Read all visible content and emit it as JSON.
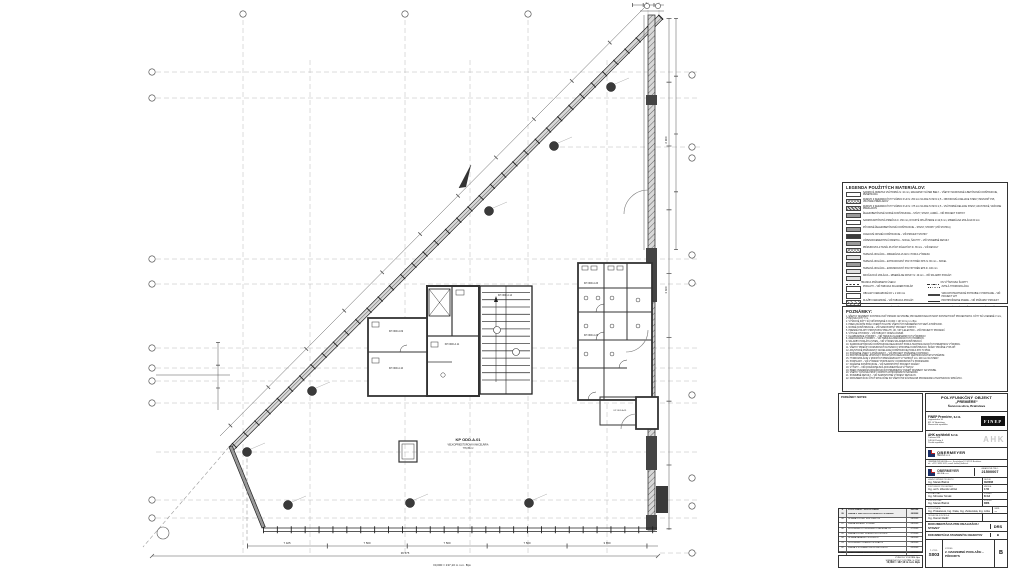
{
  "plan": {
    "labels": {
      "open_space_code": "KP ODD.A.01",
      "open_space_name": "VEĽKOPRIESTOROVÁ KANCELÁRIA",
      "open_space_area": "779,35 m²",
      "core_room": "KP ODD.A.11",
      "stair_room": "KP ODD.A.14",
      "room_w1": "KP ODD.A.09",
      "room_w2": "KP ODD.A.10",
      "wc_room_1": "KP ODD.A.26",
      "wc_room_2": "KP ODD.A.28",
      "corner_room": "KP ODD.A.31"
    },
    "dims": {
      "bottom": [
        "7 425",
        "7 500",
        "7 500",
        "7 500",
        "3 650"
      ],
      "bottom_total": "36 575",
      "right_upper": "6 900",
      "right_lower": "3 600",
      "datum_note": "±0,000 = 137,10 m n.m. Bpv"
    }
  },
  "legend": {
    "title": "LEGENDA POUŽITÝCH MATERIÁLOV:",
    "rows": [
      {
        "cls": "plain",
        "t": "SADROVÁ OMIETKA VNÚTORNÁ hr. 10 mm, MALIARSKY NÁTER BIELY – VŠETKY MUROVANÉ A BETÓNOVÉ KONŠTRUKCIE, PENETRÁCIA"
      },
      {
        "cls": "cross",
        "t": "MURIVO Z KERAMICKÝCH TVÁRNIC P+D hr. 250 mm NA MALTU MVC 2,5 – OBVODOVÉ A DELIACE STENY, PEVNOSŤ P15, VRÁTANE PREKLADOV"
      },
      {
        "cls": "hatchdark",
        "t": "MURIVO Z KERAMICKÝCH TVÁRNIC P+D hr. 175 mm NA MALTU MVC 2,5 – VNÚTORNÉ DELIACE STENY, AKUSTICKÉ, VRÁTANE PREKLADOV"
      },
      {
        "cls": "gray",
        "t": "ŽELEZOBETÓNOVÉ NOSNÉ KONŠTRUKCIE – STĹPY, STENY, JADRÁ – VIĎ PROJEKT STATIKY"
      },
      {
        "cls": "plain",
        "t": "SADROKARTÓNOVÁ PRIEČKA hr. 150 mm, DVOJITÉ OPLÁŠTENIE 2×12,5 mm, MINERÁLNA IZOLÁCIA 60 mm"
      },
      {
        "cls": "gray",
        "t": "PÔVODNÉ ŽELEZOBETÓNOVÉ KONŠTRUKCIE – STENY, STROPY (VIĎ STATIKA)"
      },
      {
        "cls": "dark",
        "t": "OCEĽOVÉ NOSNÉ KONŠTRUKCIE – VIĎ PROJEKT STATIKY"
      },
      {
        "cls": "gray",
        "t": "VÁPENNOCEMENTOVÁ OMIETKA – SOKLE, ŠACHTY – VIĎ STAVEBNÉ DETAILY"
      },
      {
        "cls": "cross",
        "t": "PRÍMUROVKA Z TEHÁL PLNÝCH PÁLENÝCH hr. 65 mm – VIĎ DETAILY"
      },
      {
        "cls": "light",
        "t": "TEPELNÁ IZOLÁCIA – MINERÁLNA VLNA hr. PODĽA VÝKRESU"
      },
      {
        "cls": "gray",
        "t": "TEPELNÁ IZOLÁCIA – EXTRUDOVANÝ POLYSTYRÉN XPS hr. 80 mm – SOKEL"
      },
      {
        "cls": "light",
        "t": "TEPELNÁ IZOLÁCIA – EXPANDOVANÝ POLYSTYRÉN EPS hr. 100 mm"
      },
      {
        "cls": "light",
        "t": "KROČAJOVÁ IZOLÁCIA – MINERÁLNE DOSKY hr. 40 mm – VIĎ SKLADBY PODLÁH"
      },
      {
        "cls": "dashline",
        "t": "HRANICA POŽIARNEHO ÚSEKU",
        "r": "OS VÝŤAHOVEJ ŠACHTY",
        "rcls": "dashdot"
      },
      {
        "cls": "plain",
        "t": "PODLAHY – VIĎ TABUĽKA SKLADIEB PODLÁH",
        "r": "ZVISLÁ HYDROIZOLÁCIA",
        "rcls": "dotted"
      },
      {
        "cls": "plain",
        "t": "OBKLADY KERAMICKÉ DO v. 2 100 mm",
        "r": "VZDUCHOTECHNICKÉ POTRUBIE V PODHĽADE – VIĎ PROJEKT VZT",
        "rcls": "thick"
      },
      {
        "cls": "hatch",
        "t": "DLAŽBY KERAMICKÉ – VIĎ TABUĽKA PODLÁH",
        "r": "PROTIPOŽIARNE DVERE – VIĎ POŽIARNY PROJEKT",
        "rcls": "thin"
      },
      {
        "cls": "plain",
        "t": "PODHĽADY SADROKARTÓNOVÉ",
        "r": "ZASKLENÁ FASÁDA (VIĎ PROJEKT FASÁDY + TČ)",
        "rcls": "thick"
      }
    ]
  },
  "notes": {
    "title": "POZNÁMKY:",
    "lines": [
      "1.  VŠETKY ROZMERY KONTROLOVAŤ PRIAMO NA STAVBE; PRI NEZROVNALOSTIACH KONTAKTOVAŤ PROJEKTANTA. KÓTY SÚ UVEDENÉ V mm, VÝŠKOVÉ KÓTY V m.",
      "2.  VÝŠKOVÉ KÓTY SÚ VZŤAHOVANÉ K ±0,000 = 137,10 m n.m. Bpv.",
      "3.  PRED ZAČATÍM PRÁC OVERIŤ POLOHU VŠETKÝCH INŽINIERSKYCH SIETÍ A PRÍPOJOK.",
      "4.  NOSNÉ KONŠTRUKCIE – VIĎ SAMOSTATNÝ PROJEKT STATIKY.",
      "5.  PRESNÉ POLOHY PROSTUPOV PRE ZTI, ÚK, VZT A ELEKTRO – VIĎ PROJEKTY PROFESIÍ.",
      "6.  VÝPLNE OTVOROV – VIĎ TABUĽKY OKIEN A DVERÍ.",
      "7.  KLAMPIARSKE VÝROBKY – VIĎ TABUĽKA KLAMPIARSKYCH VÝROBKOV.",
      "8.  ZÁMOČNÍCKE VÝROBKY – VIĎ TABUĽKA ZÁMOČNÍCKYCH VÝROBKOV.",
      "9.  SKLADBY PODLÁH A STIEN – VIĎ VÝKRES SKLADIEB KONŠTRUKCIÍ.",
      "10. SADROKARTÓNOVÉ KONŠTRUKCIE REALIZOVAŤ PODĽA TECHNOLOGICKÝCH PREDPISOV VÝROBCU.",
      "11. VŠETKY PRIEČKY DOMUROVAŤ NA TESNO K STROPNEJ KONŠTRUKCII, ŠKÁRY PRUŽNE VYPLNIŤ.",
      "12. AKUSTICKÉ POŽIADAVKY NA DELIACE KONŠTRUKCIE PODĽA STN 73 0532.",
      "13. POŽIARNE ÚSEKY A POŽIADAVKY – VIĎ PROJEKT POŽIARNEJ OCHRANY.",
      "14. PROTIPOŽIARNE UPCHÁVKY PROSTUPOV REALIZOVAŤ CERTIFIKOVANÝM SYSTÉMOM.",
      "15. HYDROIZOLÁCIE V MOKRÝCH PREVÁDZKACH VYTIAHNUŤ min. 200 mm NA STENY.",
      "16. PODHĽADY – VIĎ VÝKRESY PODHĽADOV; KOORDINOVAŤ S PROFESIAMI.",
      "17. FASÁDNE KONŠTRUKCIE – VIĎ SAMOSTATNÝ PROJEKT FASÁDY.",
      "18. VÝŤAHY – VIĎ DODÁVATEĽSKÁ DOKUMENTÁCIA VÝŤAHOV.",
      "19. PRED OSADENÍM ZARIAĎOVACÍCH PREDMETOV OVERIŤ ROZMERY NA STAVBE.",
      "20. VŠETKY KOVOVÉ PRVKY OPATRIŤ ANTIKORÓZNYM NÁTEROM.",
      "21. STAVEBNÉ DETAILY – VIĎ SAMOSTATNÉ VÝKRESY DETAILOV.",
      "22. DOKUMENTÁCIU ČÍTAŤ SPOLOČNE SO VŠETKÝMI SÚVISIACIMI PROFESIAMI A TECHNICKOU SPRÁVOU."
    ]
  },
  "notes_small": {
    "title": "POZNÁMKY:  NOTES:"
  },
  "revisions": {
    "header": {
      "i": "R",
      "t": "POPIS ZMENY / DÔVOD ZMENY",
      "d": "DÁTUM"
    },
    "rows": [
      {
        "i": "09",
        "t": "ZMENA V DISPOZÍCII HYGIENICKÝCH JADIER",
        "d": "09/2008"
      },
      {
        "i": "08",
        "t": "ÚPRAVA POLOHY SDK PRIEČOK",
        "d": "08/2008"
      },
      {
        "i": "07",
        "t": "ZMENA SKLADBY PODLÁH",
        "d": "08/2008"
      },
      {
        "i": "06",
        "t": "DOPLNENIE KÓT A LEGENDY MATERIÁLOV",
        "d": "07/2008"
      },
      {
        "i": "05",
        "t": "ZMENA POLOHY DVERNÝCH OTVOROV",
        "d": "07/2008"
      },
      {
        "i": "04",
        "t": "ÚPRAVA FASÁDNYCH PRVKOV",
        "d": "06/2008"
      },
      {
        "i": "03",
        "t": "DOPLNENIE POŽIARNYCH ÚDAJOV",
        "d": "06/2008"
      },
      {
        "i": "02",
        "t": "ZMENA V ROZSAHU SDK KONŠTRUKCIÍ",
        "d": "05/2008"
      },
      {
        "i": "01",
        "t": "PRVÉ VYDANIE DOKUMENTÁCIE",
        "d": "04/2008"
      }
    ]
  },
  "datum_box": {
    "lines": [
      {
        "t": "VÝŠKOVÝ SYSTÉM: Bpv",
        "b": ""
      },
      {
        "t": "SÚRADNICOVÝ SYSTÉM: S-JTSK",
        "b": ""
      },
      {
        "t": "±0,000 = 137,10 m n.m. Bpv",
        "b": "bold"
      }
    ]
  },
  "titleblock": {
    "project": {
      "l1": "POLYFUNKČNÝ OBJEKT",
      "l2": "„PREMIÉRE“",
      "l3": "Šancova ulica, Bratislava"
    },
    "investor": {
      "role": "INVESTOR:",
      "name": "FINEP Premiére, s.r.o.",
      "a1": "Legionárska 10",
      "a2": "811 07 Bratislava",
      "a3": "Slovenská republika",
      "logo": "FINEP"
    },
    "architect": {
      "role": "ARCHITEKT:",
      "name": "AHK architekti s.r.o.",
      "a1": "Türkova 828",
      "a2": "149 00 Praha 4",
      "a3": "Česká republika",
      "logo": "AHK"
    },
    "gp1": {
      "role": "GENERÁLNY PROJEKTANT:",
      "name": "OBERMEYER",
      "sub": "HELIKA s.r.o."
    },
    "gp1_addr1": "OBERMEYER HELIKA s.r.o., Kresánkova 12, 841 05 Bratislava",
    "gp1_addr2": "tel.: +421 2 6930 1011, e-mail: helika@helika.sk",
    "gp2": {
      "name": "OBERMEYER",
      "sub": "HELIKA s.r.o.",
      "zak_label": "ZÁKAZKOVÉ ČÍSLO:",
      "zak": "21500007"
    },
    "people": [
      {
        "role": "HLAVNÝ INŽINIER PROJEKTU:",
        "name": "Ing. Marek Blahút",
        "kl": "DÁTUM:",
        "kv": "09/2008"
      },
      {
        "role": "ZODPOVEDNÝ PROJEKTANT:",
        "name": "Ing. arch. Zdeněk Hölzel",
        "kl": "MIERKA:",
        "kv": "1:50"
      },
      {
        "role": "VYPRACOVAL:",
        "name": "Ing. Miroslav Šimák",
        "kl": "FORMÁT:",
        "kv": "8×A4"
      },
      {
        "role": "KONTROLOVAL:",
        "name": "Ing. Marek Blahút",
        "kl": "STUPEŇ:",
        "kv": "DRS"
      },
      {
        "role": "SPOLUPRÁCA:",
        "name": "Ing. Prokešová, Ing. Fiala, Ing. Zvolenská, Ing. Liška",
        "kl": "PARÉ:",
        "kv": "—"
      },
      {
        "role": "TECHNICKÁ KONTROLA:",
        "name": "Ing. Daniel Radič",
        "kl": "",
        "kv": ""
      }
    ],
    "stage1": {
      "text": "DOKUMENTÁCIA PRE REALIZÁCIU STAVBY",
      "code": "DRS"
    },
    "stage2": {
      "text": "DOKUMENTÁCIA STAVEBNÝCH OBJEKTOV",
      "code": "B"
    },
    "drawing": {
      "num_label": "Č. VÝKR.:",
      "num": "S003",
      "name_label": "VÝKRES:",
      "name": "2. NADZEMNÉ PODLAŽIE – PÔDORYS",
      "rev": "B"
    }
  }
}
